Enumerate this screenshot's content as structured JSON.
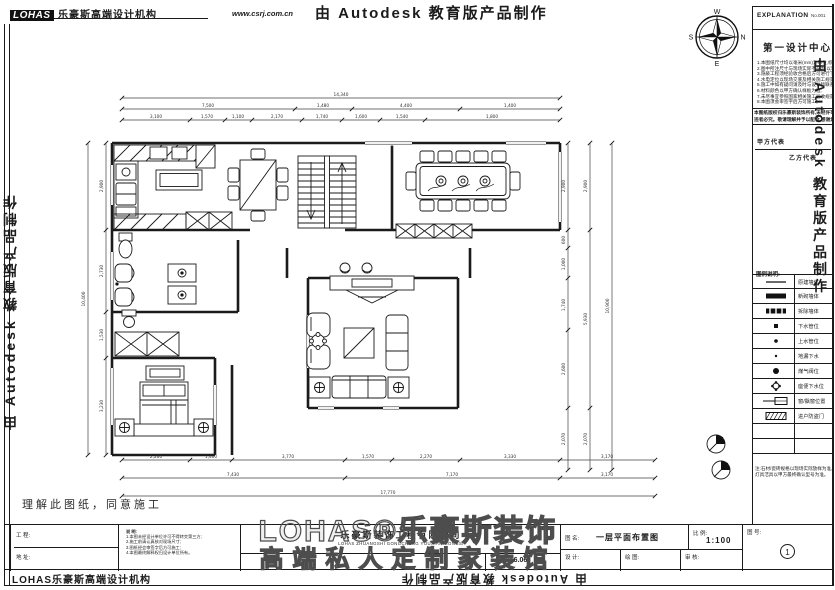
{
  "header": {
    "logo_mark": "LOHAS",
    "logo_text": "乐豪斯高端设计机构",
    "website": "www.csrj.com.cn",
    "autodesk_banner": "由 Autodesk 教育版产品制作"
  },
  "compass": {
    "north": "N",
    "south": "S",
    "east": "E",
    "west": "W"
  },
  "sidebar": {
    "explanation_title": "EXPLANATION",
    "explanation_no": "No.001",
    "studio_name": "第一设计中心",
    "spec_lines": [
      "1.本图纸尺寸均以毫米(mm)为单位,标高以米(m)为单位;",
      "2.图中所注尺寸与现场实际不符时,以现场实际为准;",
      "3.隐蔽工程须经验收合格后方可进行下道工序施工;",
      "4.水电定位以现场交底及相关施工规范为准;",
      "5.施工中如有疑问请及时与设计师联系解决;",
      "6.材料颜色以甲方确认样板为准;",
      "7.未尽事宜参照国家相关施工验收规范执行;",
      "8.本图须会审签字后方可施工。"
    ],
    "notice_lines": [
      "本图纸版权归乐豪斯装饰所有,未经许可不得复制转借或挪作他用,",
      "违者必究。敬请理解并予以配合,感谢您的支持与合作。"
    ],
    "party_a_label": "甲方代表",
    "party_b_label": "乙方代表",
    "legend_title": "图例说明:",
    "legend": [
      {
        "label": "原建墙体"
      },
      {
        "label": "新砌墙体"
      },
      {
        "label": "拆除墙体"
      },
      {
        "label": "下水管位"
      },
      {
        "label": "上水管位"
      },
      {
        "label": "地漏下水"
      },
      {
        "label": "煤气阀位"
      },
      {
        "label": "座便下水位"
      },
      {
        "label": "窗/飘窗位置"
      },
      {
        "label": "进户防盗门"
      }
    ],
    "bottom_note_lines": [
      "注:石材/瓷砖规格以现场实际放样为准,",
      "灯具洁具以甲方最终确认型号为准。"
    ]
  },
  "plan": {
    "declaration": "理解此图纸，同意施工"
  },
  "dims": {
    "top": {
      "total": "14,340",
      "row2": [
        "7,500",
        "1,480",
        "4,400",
        "1,400"
      ],
      "row1": [
        "3,100",
        "1,570",
        "1,100",
        "2,170",
        "1,740",
        "1,600",
        "1,540",
        "1,800"
      ]
    },
    "bottom": {
      "row1": [
        "2,260",
        "1,400",
        "3,770",
        "1,570",
        "2,270",
        "3,330",
        "3,170"
      ],
      "row2": [
        "7,430",
        "7,170",
        "3,170"
      ],
      "total": "17,770"
    },
    "left": {
      "col1": [
        "2,900",
        "2,730",
        "1,530",
        "3,230"
      ],
      "total": "10,400"
    },
    "right": {
      "col1": [
        "2,900",
        "600",
        "1,000",
        "1,740",
        "2,600",
        "2,070"
      ],
      "col2": [
        "2,900",
        "5,930",
        "2,070"
      ],
      "total": "10,900"
    }
  },
  "titlebar": {
    "project_label": "工 程:",
    "address_label": "地 址:",
    "note_title": "说 明:",
    "note_lines": [
      "1.本图未经设计单位许可不得转交第三方;",
      "2.施工前请认真核对现场尺寸;",
      "3.图纸经会审签字后方可施工;",
      "4.本图最终解释权归设计单位所有。"
    ],
    "company": "乐豪斯装饰工程有限公司",
    "company_en": "LOHAS ZHUANGSHI GONGCHENG YOUXIAN GONGSI",
    "date": "2016.06",
    "drawing_label": "图 名:",
    "drawing_name": "一层平面布置图",
    "scale_label": "比 例:",
    "scale_value": "1:100",
    "designer_label": "设 计:",
    "drafter_label": "绘 图:",
    "auditor_label": "审 核:",
    "sheet_label": "图 号:",
    "sheet_no": "1"
  },
  "watermark": {
    "line1": "LOHAS®乐豪斯装饰",
    "line2": "高端私人定制家装馆"
  },
  "footer": {
    "agency": "LOHAS乐豪斯高端设计机构",
    "autodesk_inverted": "由 Autodesk 教育版产品制作"
  },
  "banners": {
    "left_vertical": "由 Autodesk 教育版产品制作",
    "right_vertical": "由 Autodesk 教育版产品制作"
  }
}
